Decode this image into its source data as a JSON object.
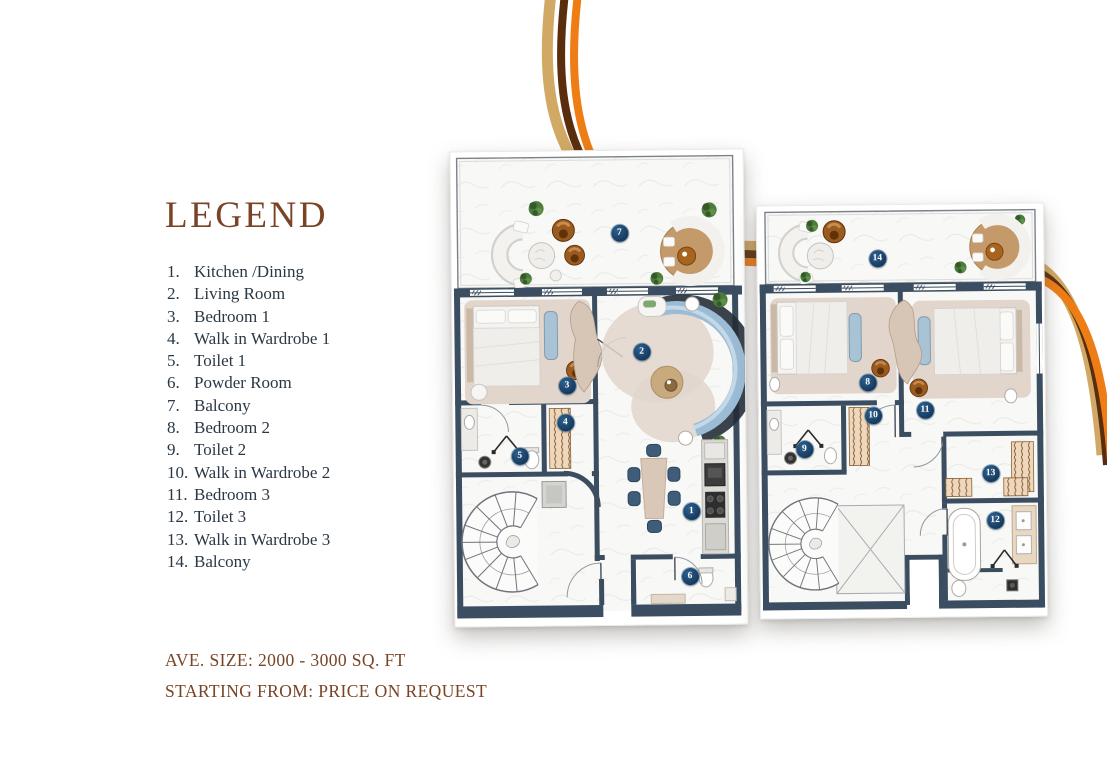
{
  "legend": {
    "title": "LEGEND",
    "items": [
      {
        "num": "1.",
        "label": "Kitchen /Dining"
      },
      {
        "num": "2.",
        "label": "Living Room"
      },
      {
        "num": "3.",
        "label": "Bedroom 1"
      },
      {
        "num": "4.",
        "label": "Walk in Wardrobe 1"
      },
      {
        "num": "5.",
        "label": "Toilet 1"
      },
      {
        "num": "6.",
        "label": "Powder Room"
      },
      {
        "num": "7.",
        "label": "Balcony"
      },
      {
        "num": "8.",
        "label": "Bedroom 2"
      },
      {
        "num": "9.",
        "label": "Toilet 2"
      },
      {
        "num": "10.",
        "label": "Walk in Wardrobe 2"
      },
      {
        "num": "11.",
        "label": "Bedroom 3"
      },
      {
        "num": "12.",
        "label": "Toilet 3"
      },
      {
        "num": "13.",
        "label": "Walk in Wardrobe 3"
      },
      {
        "num": "14.",
        "label": "Balcony"
      }
    ]
  },
  "footer": {
    "size_line": "AVE. SIZE: 2000 - 3000  SQ. FT",
    "price_line": "STARTING FROM: PRICE ON REQUEST"
  },
  "markers": {
    "m1": "1",
    "m2": "2",
    "m3": "3",
    "m4": "4",
    "m5": "5",
    "m6": "6",
    "m7": "7",
    "m8": "8",
    "m9": "9",
    "m10": "10",
    "m11": "11",
    "m12": "12",
    "m13": "13",
    "m14": "14"
  },
  "colors": {
    "accent_brown": "#7a4325",
    "legend_text_navy": "#2a3744",
    "wall_navy": "#3b4d60",
    "marker_navy": "#16395c",
    "ribbon_tan": "#d2a964",
    "ribbon_dark_brown": "#5a2d0e",
    "ribbon_orange": "#ef7d16",
    "blue_furniture": "#9cbcd6"
  }
}
